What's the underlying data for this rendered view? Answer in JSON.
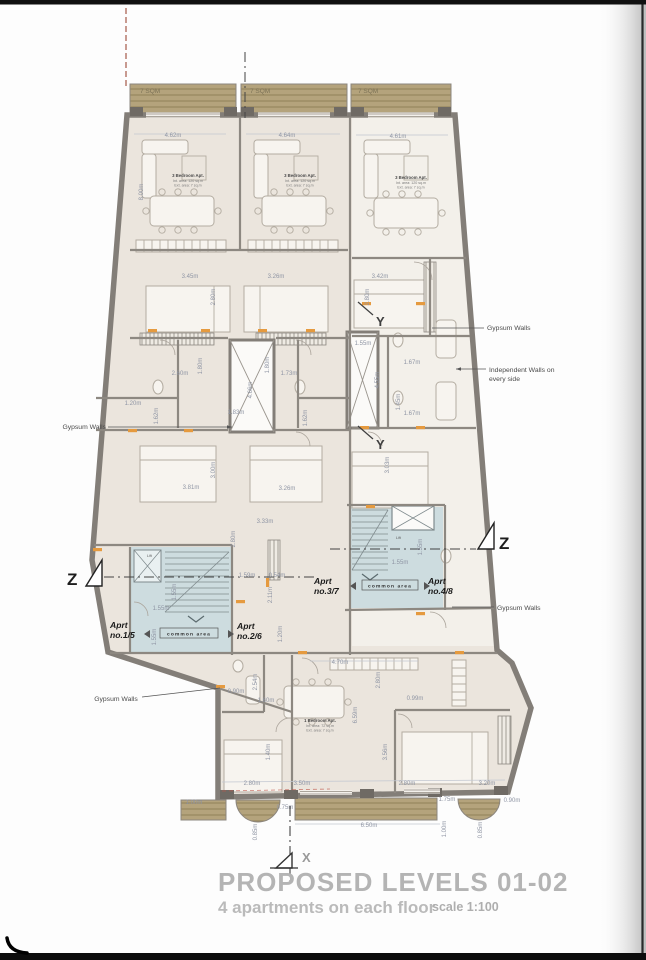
{
  "title_block": {
    "title": "PROPOSED LEVELS 01-02",
    "subtitle": "4 apartments on each floor",
    "scale": "scale 1:100"
  },
  "balconies": {
    "b1": "7 SQM",
    "b2": "7 SQM",
    "b3": "7 SQM"
  },
  "units": {
    "apt_left": {
      "name": "3 Bedroom Apt.",
      "line1": "Int. area: 120 sq.m",
      "line2": "Ext. area: 7 sq.m"
    },
    "apt_mid": {
      "name": "3 Bedroom Apt.",
      "line1": "Int. area: 120 sq.m",
      "line2": "Ext. area: 7 sq.m"
    },
    "apt_right": {
      "name": "3 Bedroom Apt.",
      "line1": "Int. area: 120 sq.m",
      "line2": "Ext. area: 7 sq.m"
    },
    "apt_bottom": {
      "name": "1 Bedroom Apt.",
      "line1": "Int. area: 72 sq.m",
      "line2": "Ext. area: 7 sq.m"
    }
  },
  "apartment_tags": {
    "a1": {
      "l1": "Aprt",
      "l2": "no.1/5"
    },
    "a2": {
      "l1": "Aprt",
      "l2": "no.2/6"
    },
    "a3": {
      "l1": "Aprt",
      "l2": "no.3/7"
    },
    "a4": {
      "l1": "Aprt",
      "l2": "no.4/8"
    }
  },
  "common": {
    "left": "common area",
    "right": "common area",
    "lift_left": "Lift",
    "lift_right": "Lift"
  },
  "annotations": {
    "gypsum_left_upper": "Gypsum Walls",
    "gypsum_left_lower": "Gypsum Walls",
    "gypsum_right_upper": "Gypsum Walls",
    "gypsum_right_lower": "Gypsum Walls",
    "independent_line1": "Independent Walls on",
    "independent_line2": "every side"
  },
  "markers": {
    "x": "X",
    "y_upper": "Y",
    "y_lower": "Y",
    "z_left": "Z",
    "z_right": "Z"
  },
  "colors": {
    "floor": "#ebe5dd",
    "floor_right": "#f3f0ea",
    "wall": "#837e78",
    "deck": "#b4a37c",
    "deck_line": "#97865e",
    "common_blue": "#cddcdf",
    "orange_accent": "#e59a3f",
    "dim_text": "#8f95a4",
    "title_gray": "#b4b4b4",
    "red_dash": "#9c4a38"
  },
  "dimensions": [
    {
      "t": "4.62m",
      "x": 173,
      "y": 137
    },
    {
      "t": "4.64m",
      "x": 287,
      "y": 137
    },
    {
      "t": "4.61m",
      "x": 398,
      "y": 138
    },
    {
      "t": "8.00m",
      "x": 143,
      "y": 192,
      "v": true
    },
    {
      "t": "3.45m",
      "x": 190,
      "y": 278
    },
    {
      "t": "3.26m",
      "x": 276,
      "y": 278
    },
    {
      "t": "3.42m",
      "x": 380,
      "y": 278
    },
    {
      "t": "2.80m",
      "x": 215,
      "y": 297,
      "v": true
    },
    {
      "t": "2.80m",
      "x": 369,
      "y": 297,
      "v": true
    },
    {
      "t": "2.60m",
      "x": 180,
      "y": 375
    },
    {
      "t": "1.73m",
      "x": 289,
      "y": 375
    },
    {
      "t": "1.80m",
      "x": 202,
      "y": 366,
      "v": true
    },
    {
      "t": "1.80m",
      "x": 269,
      "y": 365,
      "v": true
    },
    {
      "t": "1.20m",
      "x": 133,
      "y": 405
    },
    {
      "t": "1.62m",
      "x": 158,
      "y": 416,
      "v": true
    },
    {
      "t": "1.62m",
      "x": 307,
      "y": 418,
      "v": true
    },
    {
      "t": "1.83m",
      "x": 236,
      "y": 414
    },
    {
      "t": "4.66m",
      "x": 252,
      "y": 390,
      "v": true
    },
    {
      "t": "1.55m",
      "x": 363,
      "y": 345
    },
    {
      "t": "4.55m",
      "x": 379,
      "y": 380,
      "v": true
    },
    {
      "t": "1.67m",
      "x": 412,
      "y": 364
    },
    {
      "t": "1.45m",
      "x": 400,
      "y": 402,
      "v": true
    },
    {
      "t": "1.67m",
      "x": 412,
      "y": 415
    },
    {
      "t": "3.00m",
      "x": 215,
      "y": 470,
      "v": true
    },
    {
      "t": "3.03m",
      "x": 389,
      "y": 465,
      "v": true
    },
    {
      "t": "3.81m",
      "x": 191,
      "y": 489
    },
    {
      "t": "3.26m",
      "x": 287,
      "y": 490
    },
    {
      "t": "3.33m",
      "x": 265,
      "y": 523
    },
    {
      "t": "2.80m",
      "x": 235,
      "y": 539,
      "v": true
    },
    {
      "t": "1.59m",
      "x": 247,
      "y": 577
    },
    {
      "t": "0.54m",
      "x": 277,
      "y": 577
    },
    {
      "t": "1.55m",
      "x": 176,
      "y": 592,
      "v": true
    },
    {
      "t": "1.55m",
      "x": 161,
      "y": 610
    },
    {
      "t": "2.11m",
      "x": 272,
      "y": 595,
      "v": true
    },
    {
      "t": "1.20m",
      "x": 282,
      "y": 634,
      "v": true
    },
    {
      "t": "1.55m",
      "x": 156,
      "y": 637,
      "v": true
    },
    {
      "t": "1.55m",
      "x": 400,
      "y": 564
    },
    {
      "t": "1.55m",
      "x": 422,
      "y": 547,
      "v": true
    },
    {
      "t": "4.70m",
      "x": 340,
      "y": 664
    },
    {
      "t": "2.54m",
      "x": 257,
      "y": 682,
      "v": true
    },
    {
      "t": "2.80m",
      "x": 380,
      "y": 680,
      "v": true
    },
    {
      "t": "0.90m",
      "x": 236,
      "y": 693
    },
    {
      "t": "1.60m",
      "x": 266,
      "y": 702
    },
    {
      "t": "0.99m",
      "x": 415,
      "y": 700
    },
    {
      "t": "6.59m",
      "x": 357,
      "y": 715,
      "v": true
    },
    {
      "t": "1.40m",
      "x": 270,
      "y": 752,
      "v": true
    },
    {
      "t": "3.56m",
      "x": 387,
      "y": 752,
      "v": true
    },
    {
      "t": "2.80m",
      "x": 252,
      "y": 785
    },
    {
      "t": "3.50m",
      "x": 302,
      "y": 785
    },
    {
      "t": "2.80m",
      "x": 407,
      "y": 785
    },
    {
      "t": "3.20m",
      "x": 487,
      "y": 785
    },
    {
      "t": "1.00m",
      "x": 194,
      "y": 804
    },
    {
      "t": "0.75m",
      "x": 285,
      "y": 809
    },
    {
      "t": "6.50m",
      "x": 369,
      "y": 827
    },
    {
      "t": "1.75m",
      "x": 447,
      "y": 801
    },
    {
      "t": "0.90m",
      "x": 512,
      "y": 802
    },
    {
      "t": "1.00m",
      "x": 446,
      "y": 829,
      "v": true
    },
    {
      "t": "0.85m",
      "x": 257,
      "y": 832,
      "v": true
    },
    {
      "t": "0.85m",
      "x": 482,
      "y": 830,
      "v": true
    }
  ]
}
